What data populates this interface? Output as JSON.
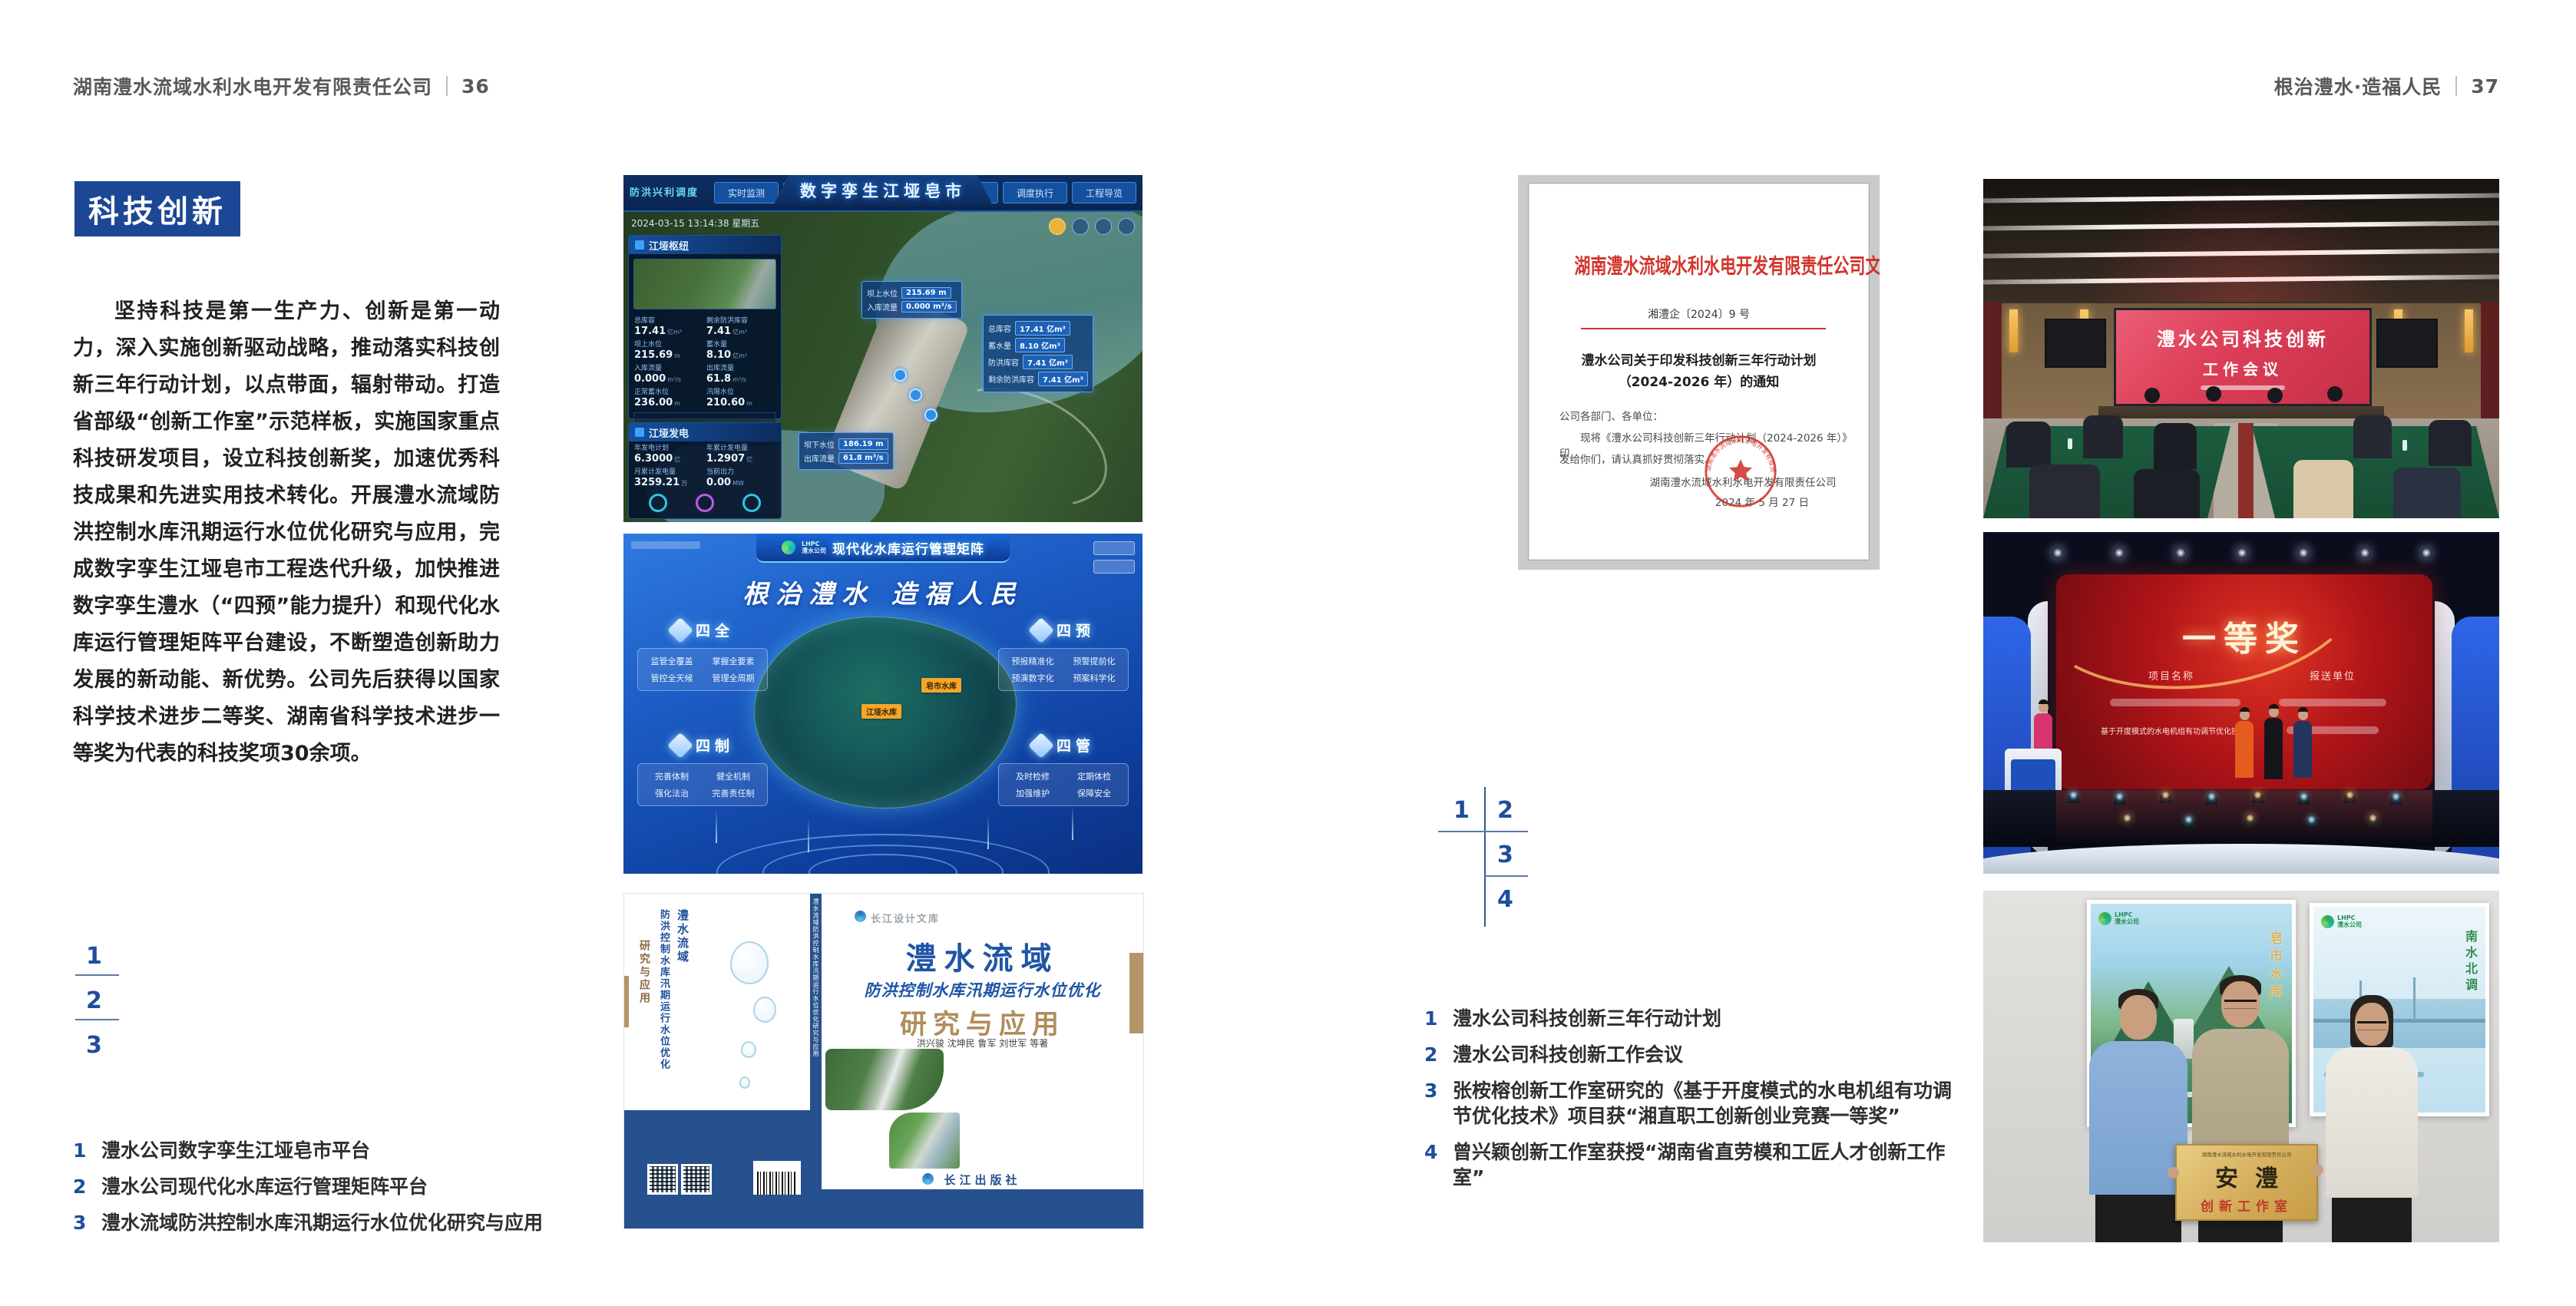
{
  "colors": {
    "accent_blue": "#1c4795",
    "band_blue": "#27508f",
    "doc_red": "#d2342c"
  },
  "left_page": {
    "header": {
      "company": "湖南澧水流域水利水电开发有限责任公司",
      "page_number": "36"
    },
    "badge": "科技创新",
    "paragraph": "坚持科技是第一生产力、创新是第一动力，深入实施创新驱动战略，推动落实科技创新三年行动计划，以点带面，辐射带动。打造省部级“创新工作室”示范样板，实施国家重点科技研发项目，设立科技创新奖，加速优秀科技成果和先进实用技术转化。开展澧水流域防洪控制水库汛期运行水位优化研究与应用，完成数字孪生江垭皂市工程迭代升级，加快推进数字孪生澧水（“四预”能力提升）和现代化水库运行管理矩阵平台建设，不断塑造创新助力发展的新动能、新优势。公司先后获得以国家科学技术进步二等奖、湖南省科学技术进步一等奖为代表的科技奖项30余项。",
    "figure_markers": [
      "1",
      "2",
      "3"
    ],
    "captions": [
      {
        "num": "1",
        "text": "澧水公司数字孪生江垭皂市平台"
      },
      {
        "num": "2",
        "text": "澧水公司现代化水库运行管理矩阵平台"
      },
      {
        "num": "3",
        "text": "澧水流域防洪控制水库汛期运行水位优化研究与应用"
      }
    ]
  },
  "right_page": {
    "header": {
      "slogan": "根治澧水·造福人民",
      "page_number": "37"
    },
    "figure_markers": [
      "1",
      "2",
      "3",
      "4"
    ],
    "captions": [
      {
        "num": "1",
        "text": "澧水公司科技创新三年行动计划"
      },
      {
        "num": "2",
        "text": "澧水公司科技创新工作会议"
      },
      {
        "num": "3",
        "text": "张桉榕创新工作室研究的《基于开度模式的水电机组有功调节优化技术》项目获“湘直职工创新创业竞赛一等奖”"
      },
      {
        "num": "4",
        "text": "曾兴颖创新工作室获授“湖南省直劳模和工匠人才创新工作室”"
      }
    ]
  },
  "dashboard": {
    "title": "数字孪生江垭皂市",
    "brand": "防洪兴利调度",
    "timestamp": "2024-03-15 13:14:38 星期五",
    "tabs_left": [
      "实时监测",
      "洪水预报",
      "防洪预警"
    ],
    "tabs_right": [
      "气象预测",
      "预案生成",
      "调度执行",
      "工程导览"
    ],
    "panel_hub": {
      "title": "江垭枢纽",
      "stats": [
        {
          "label": "总库容",
          "value": "17.41",
          "unit": "亿m³"
        },
        {
          "label": "剩余防洪库容",
          "value": "7.41",
          "unit": "亿m³"
        },
        {
          "label": "坝上水位",
          "value": "215.69",
          "unit": "m"
        },
        {
          "label": "蓄水量",
          "value": "8.10",
          "unit": "亿m³"
        },
        {
          "label": "入库流量",
          "value": "0.000",
          "unit": "m³/s"
        },
        {
          "label": "出库流量",
          "value": "61.8",
          "unit": "m³/s"
        },
        {
          "label": "正常蓄水位",
          "value": "236.00",
          "unit": "m"
        },
        {
          "label": "汛限水位",
          "value": "210.60",
          "unit": "m"
        }
      ]
    },
    "panel_power": {
      "title": "江垭发电",
      "stats": [
        {
          "label": "年发电计划",
          "value": "6.3000",
          "unit": "亿"
        },
        {
          "label": "年累计发电量",
          "value": "1.2907",
          "unit": "亿"
        },
        {
          "label": "月累计发电量",
          "value": "3259.21",
          "unit": "万"
        },
        {
          "label": "当前出力",
          "value": "0.00",
          "unit": "MW"
        }
      ]
    },
    "callout_up": {
      "rows": [
        {
          "label": "坝上水位",
          "value": "215.69 m"
        },
        {
          "label": "入库流量",
          "value": "0.000 m³/s"
        }
      ]
    },
    "callout_storage": {
      "rows": [
        {
          "label": "总库容",
          "value": "17.41 亿m³"
        },
        {
          "label": "蓄水量",
          "value": "8.10 亿m³"
        },
        {
          "label": "防洪库容",
          "value": "7.41 亿m³"
        },
        {
          "label": "剩余防洪库容",
          "value": "7.41 亿m³"
        }
      ]
    },
    "callout_down": {
      "rows": [
        {
          "label": "坝下水位",
          "value": "186.19 m"
        },
        {
          "label": "出库流量",
          "value": "61.8 m³/s"
        }
      ]
    }
  },
  "matrix": {
    "logo": "LHPC",
    "logo_sub": "澧水公司",
    "title": "现代化水库运行管理矩阵",
    "slogan": "根治澧水 造福人民",
    "groups": [
      {
        "label": "四全",
        "items": [
          "监管全覆盖",
          "掌握全要素",
          "管控全天候",
          "管理全周期"
        ]
      },
      {
        "label": "四预",
        "items": [
          "预报精准化",
          "预警提前化",
          "预演数字化",
          "预案科学化"
        ]
      },
      {
        "label": "四制",
        "items": [
          "完善体制",
          "健全机制",
          "强化法治",
          "完善责任制"
        ]
      },
      {
        "label": "四管",
        "items": [
          "及时检修",
          "定期体检",
          "加强维护",
          "保障安全"
        ]
      }
    ],
    "markers": [
      "皂市水库",
      "江垭水库"
    ]
  },
  "book": {
    "series": "长江设计文库",
    "title": "澧水流域",
    "subtitle": "防洪控制水库汛期运行水位优化",
    "title2": "研究与应用",
    "authors": "洪兴骏  沈坤民  鲁军  刘世军  等著",
    "publisher": "长江出版社",
    "spine": "澧水流域防洪控制水库汛期运行水位优化研究与应用",
    "back_title_1": "澧水流域",
    "back_title_2": "防洪控制水库汛期运行水位优化",
    "back_title_3": "研究与应用"
  },
  "document": {
    "header": "湖南澧水流域水利水电开发有限责任公司文件",
    "doc_no": "湘澧企〔2024〕9 号",
    "title_line1": "澧水公司关于印发科技创新三年行动计划",
    "title_line2": "（2024-2026 年）的通知",
    "salutation": "公司各部门、各单位：",
    "body_line1": "现将《澧水公司科技创新三年行动计划（2024-2026 年）》印",
    "body_line2": "发给你们，请认真抓好贯彻落实。",
    "signature": "湖南澧水流域水利水电开发有限责任公司",
    "date": "2024 年 5 月 27 日",
    "seal_text": "湖南澧水流域水利水电开发有限责任公司"
  },
  "meeting": {
    "screen_line1": "澧水公司科技创新",
    "screen_line2": "工作会议"
  },
  "award": {
    "title": "一等奖",
    "col1": "项目名称",
    "col2": "报送单位",
    "project": "基于开度模式的水电机组有功调节优化技术"
  },
  "studio": {
    "plaque_top": "湖南澧水流域水利水电开发有限责任公司",
    "plaque_main": "安澧",
    "plaque_sub": "创新工作室",
    "poster_left_text": "皂市水库",
    "poster_right_text": "南水北调",
    "poster_logo_main": "LHPC",
    "poster_logo_sub": "澧水公司"
  }
}
